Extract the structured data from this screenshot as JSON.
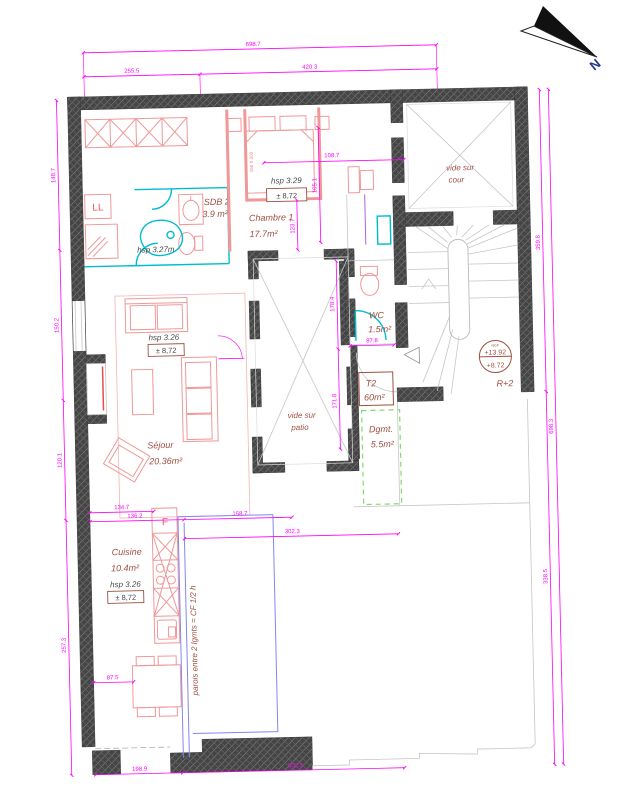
{
  "colors": {
    "wall": "#454545",
    "dimension": "#ff00ff",
    "furniture": "#f09898",
    "fixtures_cyan": "#00bcd0",
    "labels_brown": "#9c5040",
    "fire_limit_green": "#86d96a",
    "cf_wall_blue": "#8486f0"
  },
  "north": {
    "label": "N"
  },
  "rooms": {
    "sdb2": {
      "name": "SDB 2",
      "area": "3.9 m²",
      "hsp": "hsp 3.27m"
    },
    "chambre1": {
      "name": "Chambre 1",
      "area": "17.7m²",
      "hsp": "hsp 3.29",
      "level": "± 8,72"
    },
    "sejour": {
      "name": "Séjour",
      "area": "20.36m²",
      "hsp": "hsp 3.26",
      "level": "± 8,72"
    },
    "cuisine": {
      "name": "Cuisine",
      "area": "10.4m²",
      "hsp": "hsp 3.26",
      "level": "± 8,72"
    },
    "wc": {
      "name": "WC",
      "area": "1.5m²"
    },
    "dgmt": {
      "name": "Dgmt.",
      "area": "5.5m²"
    },
    "t2": {
      "name": "T2",
      "area": "60m²"
    },
    "patio": {
      "line1": "vide sur",
      "line2": "patio"
    },
    "cour": {
      "line1": "vide sur",
      "line2": "cour"
    }
  },
  "stair": {
    "ngf": "NGF",
    "upper": "+13.92",
    "lower": "+8.72",
    "floor": "R+2"
  },
  "annotations": {
    "fire_wall": "parois entre 2 lgmts = CF 1/2 h",
    "washer": "LL",
    "fridge": "F",
    "bed_size": "160 X 200"
  },
  "dims": {
    "top_overall": "698.7",
    "top_left": "255.5",
    "top_right": "420.3",
    "right_outer": "698.3",
    "right_upper": "359.8",
    "right_lower": "338.5",
    "left_1": "148.7",
    "left_2": "150.2",
    "left_3": "120.1",
    "left_4": "257.3",
    "chambre_width": "108.7",
    "wardrobe_height": "105.1",
    "chambre_depth": "123.7",
    "patio_upper": "178.4",
    "patio_lower": "171.8",
    "cuisine_a": "134.7",
    "cuisine_b": "136.2",
    "cuisine_c": "158.7",
    "cuisine_d": "302.3",
    "wc_width": "87.8",
    "table_offset": "87.5",
    "bottom_left": "198.9",
    "bottom_right": "502.5"
  }
}
